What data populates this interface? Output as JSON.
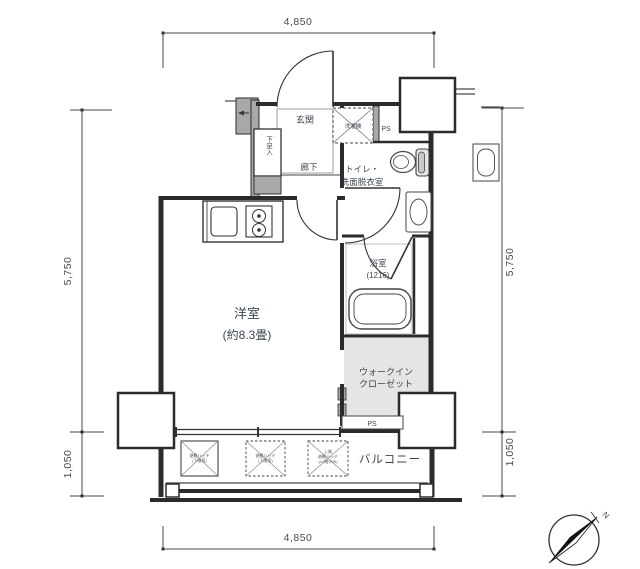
{
  "dimensions": {
    "top": "4,850",
    "bottom": "4,850",
    "left_main": "5,750",
    "left_balcony": "1,050",
    "right_main": "5,750",
    "right_balcony": "1,050"
  },
  "rooms": {
    "entrance": "玄関",
    "shoe_box": "下足入",
    "corridor": "廊下",
    "washroom_line1": "トイレ・",
    "washroom_line2": "洗面脱衣室",
    "bathroom_line1": "浴室",
    "bathroom_line2": "(1216)",
    "living_line1": "洋室",
    "living_line2": "(約8.3畳)",
    "wic_line1": "ウォークイン",
    "wic_line2": "クローゼット",
    "balcony": "バルコニー"
  },
  "equipment": {
    "pipe_space_top": "PS",
    "pipe_space_bottom": "PS",
    "washer": "洗濯機",
    "hatch1_line1": "避難ハッチ",
    "hatch1_line2": "(下階用)",
    "hatch2_line1": "避難ハッチ",
    "hatch2_line2": "(下階用)",
    "hatch3_line1": "上階",
    "hatch3_line2": "避難ハッチ",
    "hatch3_line3": "(14階のみ)"
  },
  "compass": {
    "north": "N"
  },
  "colors": {
    "wall": "#2b2b2b",
    "label": "#3c4650",
    "dimension": "#4a4a4a",
    "wic_fill": "#e5e5e5",
    "pier_fill": "#a8a8a8"
  }
}
